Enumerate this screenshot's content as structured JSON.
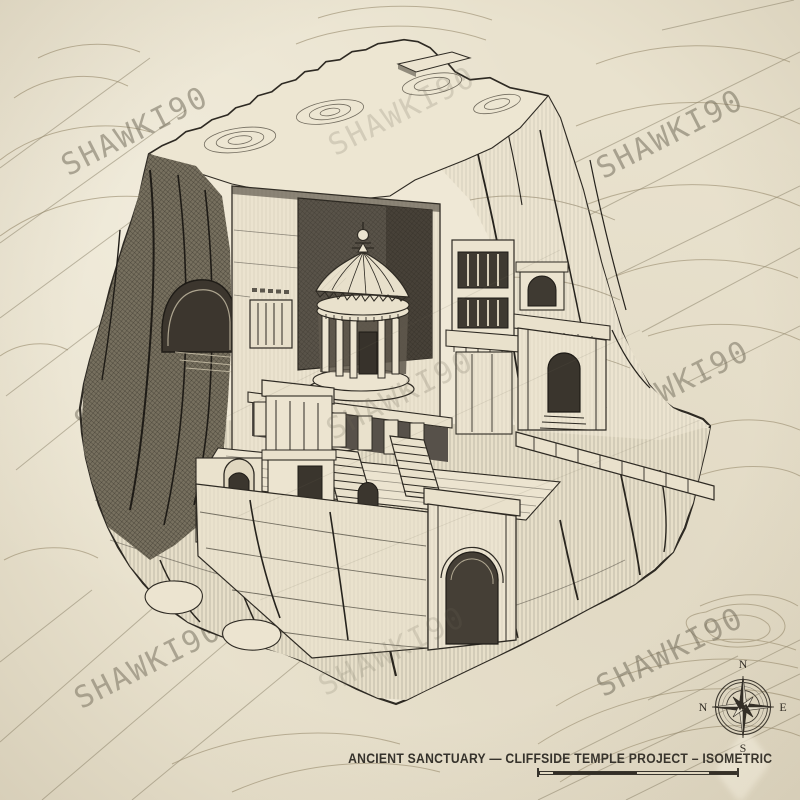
{
  "watermark": {
    "text": "SHAWKI90"
  },
  "caption": {
    "text": "ANCIENT SANCTUARY — CLIFFSIDE TEMPLE PROJECT – ISOMETRIC"
  },
  "compass": {
    "north": "N",
    "east": "E",
    "south": "S",
    "west": "N"
  },
  "palette": {
    "paper": "#e9e2ce",
    "ink": "#2e2a23",
    "contour": "#a89c80",
    "watermark": "#6e6857",
    "caption": "#33302a"
  },
  "illustration": {
    "subject": "Isometric pen-and-ink drawing of an ancient sanctuary carved into a cliffside rock massif",
    "features": [
      "round tholos temple in carved niche",
      "carved facade with windows and balconies",
      "colonnade terrace with twin staircases",
      "arched gate in lower wall",
      "cave opening in left cliff",
      "topographic plateau summit",
      "fissured rock base"
    ]
  }
}
